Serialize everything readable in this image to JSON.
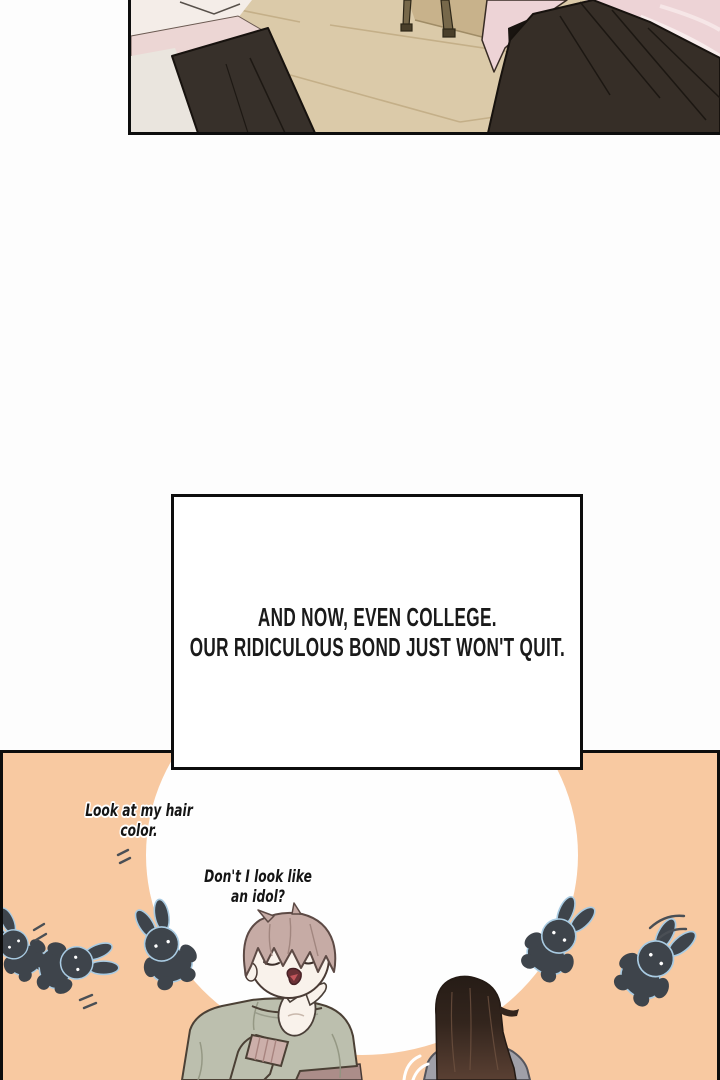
{
  "page": {
    "width": 720,
    "height": 1080,
    "kind": "webtoon comic page"
  },
  "caption": {
    "line1": "AND NOW, EVEN COLLEGE.",
    "line2": "OUR RIDICULOUS BOND JUST WON'T QUIT."
  },
  "speech_bubbles": [
    {
      "speaker": "blond-student",
      "line1": "Look at my hair",
      "line2": "color."
    },
    {
      "speaker": "blond-student",
      "line1": "Don't I look like",
      "line2": "an idol?"
    }
  ],
  "colors": {
    "page_background": "#fdfdfd",
    "panel_border": "#0d0d0d",
    "floor_beige": "#dbcaa9",
    "wall_band": "#c8b28b",
    "pink_garment": "#edd3d6",
    "dark_garment": "#362e27",
    "orange_background": "#f8c9a1",
    "spotlight_white": "#fefefe",
    "bunny_dark": "#3e444b",
    "bunny_outline_blue": "#a9cbe2",
    "hair_blond": "#c6aba5",
    "sweater_sage": "#bcbfae",
    "cuff_pink": "#ccafaa",
    "pants_mauve": "#ab8d89",
    "girl_hair_dark": "#2a201a",
    "hoodie_gray": "#a0a0a8",
    "skin": "#f9f2eb",
    "text_black": "#1a1a1a"
  }
}
